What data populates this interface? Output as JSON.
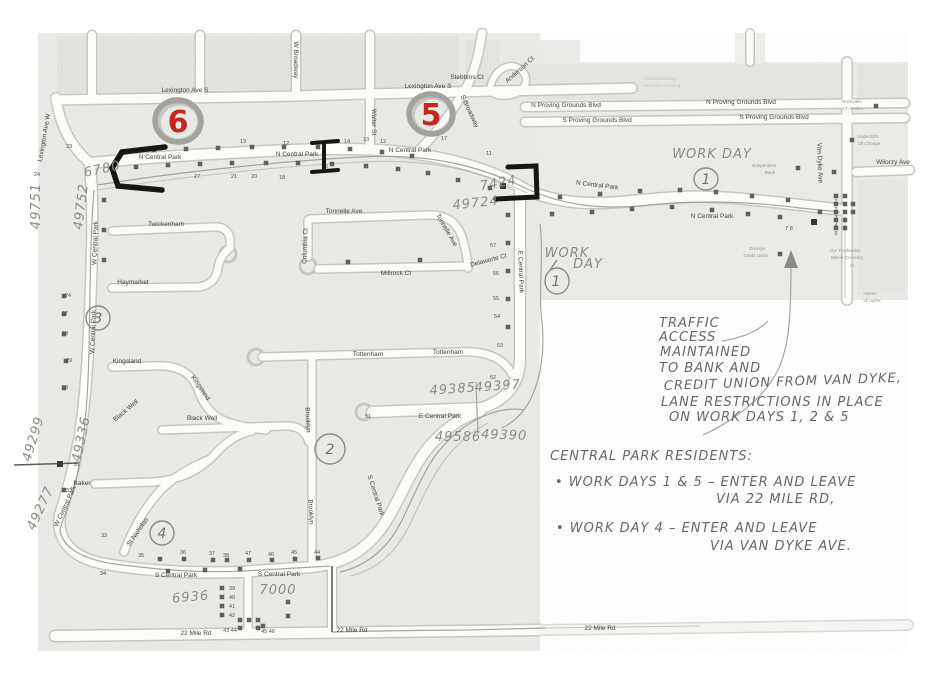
{
  "map": {
    "street_labels": [
      {
        "t": "Lexington Ave S",
        "x": 185,
        "y": 92
      },
      {
        "t": "Lexington Ave S",
        "x": 428,
        "y": 88
      },
      {
        "t": "Lexington Ave W",
        "x": 46,
        "y": 138,
        "r": -80,
        "s": 5.5
      },
      {
        "t": "W Broadway",
        "x": 294,
        "y": 60,
        "r": 90,
        "s": 5.5
      },
      {
        "t": "Walter St",
        "x": 372,
        "y": 122,
        "r": 90,
        "s": 5.5
      },
      {
        "t": "S Broadway",
        "x": 468,
        "y": 112,
        "r": 65,
        "s": 5.5
      },
      {
        "t": "Stebbins Ct",
        "x": 467,
        "y": 79,
        "s": 5.5
      },
      {
        "t": "Anderson Ct",
        "x": 521,
        "y": 71,
        "r": -42,
        "s": 5
      },
      {
        "t": "N Central Park",
        "x": 160,
        "y": 159
      },
      {
        "t": "N Central Park",
        "x": 297,
        "y": 156
      },
      {
        "t": "N Central Park",
        "x": 410,
        "y": 152
      },
      {
        "t": "N Central Park",
        "x": 597,
        "y": 187,
        "r": 7,
        "s": 6
      },
      {
        "t": "N Central Park",
        "x": 712,
        "y": 218
      },
      {
        "t": "W Central Park",
        "x": 97,
        "y": 243,
        "r": -88,
        "s": 5.5
      },
      {
        "t": "W Central Park",
        "x": 95,
        "y": 332,
        "r": -88,
        "s": 5.5
      },
      {
        "t": "W Central Park",
        "x": 67,
        "y": 507,
        "r": -65,
        "s": 5.5
      },
      {
        "t": "E Central Park",
        "x": 519,
        "y": 272,
        "r": 88,
        "s": 5.5
      },
      {
        "t": "E Central Park",
        "x": 440,
        "y": 418,
        "s": 6
      },
      {
        "t": "S Central Park",
        "x": 176,
        "y": 577,
        "s": 6
      },
      {
        "t": "S Central Park",
        "x": 279,
        "y": 576,
        "s": 6
      },
      {
        "t": "S Central Park",
        "x": 374,
        "y": 496,
        "r": 72,
        "s": 5.5
      },
      {
        "t": "22 Mile Rd",
        "x": 196,
        "y": 635
      },
      {
        "t": "22 Mile Rd",
        "x": 352,
        "y": 632
      },
      {
        "t": "22 Mile Rd",
        "x": 600,
        "y": 630,
        "s": 7
      },
      {
        "t": "N Proving Grounds Blvd",
        "x": 566,
        "y": 107,
        "s": 6
      },
      {
        "t": "N Proving Grounds Blvd",
        "x": 741,
        "y": 104,
        "s": 6
      },
      {
        "t": "S Proving Grounds Blvd",
        "x": 597,
        "y": 122,
        "s": 6
      },
      {
        "t": "S Proving Grounds Blvd",
        "x": 774,
        "y": 119,
        "s": 6
      },
      {
        "t": "Van Dyke Ave",
        "x": 818,
        "y": 163,
        "r": 88,
        "s": 6
      },
      {
        "t": "Wilorzy Ave",
        "x": 893,
        "y": 164,
        "s": 6
      },
      {
        "t": "Twickenham",
        "x": 166,
        "y": 226,
        "s": 5.5
      },
      {
        "t": "Tonnelle Ave",
        "x": 344,
        "y": 213,
        "s": 5.5
      },
      {
        "t": "Tonnelle Ave",
        "x": 445,
        "y": 231,
        "r": 60,
        "s": 5.5
      },
      {
        "t": "Millrock Ct",
        "x": 396,
        "y": 275,
        "s": 5.5
      },
      {
        "t": "Delaworte Ct",
        "x": 489,
        "y": 262,
        "r": -15,
        "s": 5
      },
      {
        "t": "Columbia Ct",
        "x": 307,
        "y": 246,
        "r": -88,
        "s": 5
      },
      {
        "t": "Haymarket",
        "x": 133,
        "y": 284,
        "s": 5.5
      },
      {
        "t": "Kingsland",
        "x": 127,
        "y": 363,
        "s": 5.5
      },
      {
        "t": "Kingsland",
        "x": 199,
        "y": 389,
        "r": 55,
        "s": 5.5
      },
      {
        "t": "Tottenham",
        "x": 368,
        "y": 356,
        "s": 5.5
      },
      {
        "t": "Tottenham",
        "x": 448,
        "y": 354,
        "s": 5.5
      },
      {
        "t": "Black Well",
        "x": 202,
        "y": 420,
        "s": 5.5
      },
      {
        "t": "Black Well",
        "x": 127,
        "y": 412,
        "r": -40,
        "s": 5
      },
      {
        "t": "Baker",
        "x": 82,
        "y": 485,
        "s": 5.5
      },
      {
        "t": "Brooklyn",
        "x": 306,
        "y": 420,
        "r": 88,
        "s": 5.5
      },
      {
        "t": "Brooklyn",
        "x": 309,
        "y": 512,
        "r": 88,
        "s": 5.5
      },
      {
        "t": "St Nicholas",
        "x": 139,
        "y": 533,
        "r": -55,
        "s": 5.5
      }
    ],
    "lot_numbers": [
      {
        "t": "23",
        "x": 69,
        "y": 148
      },
      {
        "t": "24",
        "x": 37,
        "y": 176
      },
      {
        "t": "27",
        "x": 197,
        "y": 178
      },
      {
        "t": "21",
        "x": 234,
        "y": 178
      },
      {
        "t": "20",
        "x": 254,
        "y": 178
      },
      {
        "t": "18",
        "x": 282,
        "y": 179
      },
      {
        "t": "13",
        "x": 243,
        "y": 143
      },
      {
        "t": "12",
        "x": 286,
        "y": 145
      },
      {
        "t": "14",
        "x": 347,
        "y": 143
      },
      {
        "t": "13",
        "x": 366,
        "y": 141
      },
      {
        "t": "12",
        "x": 383,
        "y": 143
      },
      {
        "t": "15",
        "x": 325,
        "y": 168
      },
      {
        "t": "17",
        "x": 444,
        "y": 140
      },
      {
        "t": "11",
        "x": 489,
        "y": 155
      },
      {
        "t": "24",
        "x": 68,
        "y": 297
      },
      {
        "t": "27",
        "x": 65,
        "y": 315
      },
      {
        "t": "28",
        "x": 65,
        "y": 335
      },
      {
        "t": "29",
        "x": 69,
        "y": 362
      },
      {
        "t": "30",
        "x": 65,
        "y": 389
      },
      {
        "t": "31",
        "x": 77,
        "y": 466
      },
      {
        "t": "32",
        "x": 69,
        "y": 492
      },
      {
        "t": "33",
        "x": 104,
        "y": 537
      },
      {
        "t": "34",
        "x": 103,
        "y": 575
      },
      {
        "t": "57",
        "x": 493,
        "y": 247
      },
      {
        "t": "56",
        "x": 496,
        "y": 275
      },
      {
        "t": "55",
        "x": 496,
        "y": 300
      },
      {
        "t": "54",
        "x": 497,
        "y": 318
      },
      {
        "t": "53",
        "x": 500,
        "y": 347
      },
      {
        "t": "52",
        "x": 493,
        "y": 379
      },
      {
        "t": "51",
        "x": 368,
        "y": 418
      },
      {
        "t": "35",
        "x": 141,
        "y": 557
      },
      {
        "t": "36",
        "x": 183,
        "y": 554
      },
      {
        "t": "37",
        "x": 212,
        "y": 555
      },
      {
        "t": "38",
        "x": 226,
        "y": 557
      },
      {
        "t": "47",
        "x": 248,
        "y": 555
      },
      {
        "t": "46",
        "x": 271,
        "y": 556
      },
      {
        "t": "45",
        "x": 294,
        "y": 554
      },
      {
        "t": "44",
        "x": 317,
        "y": 554
      },
      {
        "t": "39",
        "x": 232,
        "y": 590
      },
      {
        "t": "40",
        "x": 232,
        "y": 599
      },
      {
        "t": "41",
        "x": 232,
        "y": 608
      },
      {
        "t": "42",
        "x": 232,
        "y": 617
      },
      {
        "t": "43 44",
        "x": 230,
        "y": 632
      },
      {
        "t": "45 46",
        "x": 268,
        "y": 633
      },
      {
        "t": "1",
        "x": 836,
        "y": 203
      },
      {
        "t": "2",
        "x": 836,
        "y": 211
      },
      {
        "t": "3",
        "x": 836,
        "y": 219
      },
      {
        "t": "4",
        "x": 836,
        "y": 227
      },
      {
        "t": "5",
        "x": 836,
        "y": 235
      },
      {
        "t": "7 8",
        "x": 789,
        "y": 230
      }
    ],
    "poi_labels": [
      {
        "t": "Packard Proving",
        "x": 660,
        "y": 80,
        "s": 5,
        "c": "fade"
      },
      {
        "t": "Grounds Crossing",
        "x": 662,
        "y": 87,
        "s": 5,
        "c": "fade"
      },
      {
        "t": "Rockvalle",
        "x": 852,
        "y": 103
      },
      {
        "t": "Ch Prahm",
        "x": 853,
        "y": 110
      },
      {
        "t": "Uncle Ed's",
        "x": 868,
        "y": 138
      },
      {
        "t": "Oil Change",
        "x": 869,
        "y": 145
      },
      {
        "t": "Independent",
        "x": 764,
        "y": 167
      },
      {
        "t": "Bank",
        "x": 770,
        "y": 174
      },
      {
        "t": "Genisys",
        "x": 757,
        "y": 250
      },
      {
        "t": "Credit Union",
        "x": 756,
        "y": 257
      },
      {
        "t": "Our Fredericka",
        "x": 845,
        "y": 252
      },
      {
        "t": "Manor Crossing",
        "x": 847,
        "y": 259
      },
      {
        "t": "11",
        "x": 852,
        "y": 267
      },
      {
        "t": "Haven",
        "x": 870,
        "y": 295
      },
      {
        "t": "of Lights",
        "x": 872,
        "y": 302
      }
    ]
  },
  "annotations": {
    "zone_numbers_red": [
      "6",
      "5"
    ],
    "zone_numbers_pencil": [
      "3",
      "2",
      "4"
    ],
    "work_day_circle_number": "1",
    "addresses": [
      {
        "t": "6780",
        "x": 103,
        "y": 173,
        "r": -12,
        "s": 15
      },
      {
        "t": "49751",
        "x": 40,
        "y": 206,
        "r": -90,
        "s": 11
      },
      {
        "t": "49752",
        "x": 85,
        "y": 207,
        "r": -83,
        "s": 11
      },
      {
        "t": "7424",
        "x": 499,
        "y": 187,
        "r": -10,
        "s": 14
      },
      {
        "t": "49724",
        "x": 476,
        "y": 207,
        "r": -6,
        "s": 13
      },
      {
        "t": "49385",
        "x": 453,
        "y": 393,
        "r": -4,
        "s": 13
      },
      {
        "t": "49397",
        "x": 498,
        "y": 390,
        "r": -4,
        "s": 13
      },
      {
        "t": "49586",
        "x": 458,
        "y": 441,
        "s": 13
      },
      {
        "t": "49390",
        "x": 504,
        "y": 439,
        "r": 2,
        "s": 13
      },
      {
        "t": "49299",
        "x": 37,
        "y": 440,
        "r": -73,
        "s": 11
      },
      {
        "t": "49336",
        "x": 85,
        "y": 440,
        "r": -78,
        "s": 11
      },
      {
        "t": "49277",
        "x": 44,
        "y": 510,
        "r": -65,
        "s": 11
      },
      {
        "t": "6936",
        "x": 191,
        "y": 601,
        "r": -5,
        "s": 14
      },
      {
        "t": "7000",
        "x": 278,
        "y": 594,
        "s": 14
      }
    ],
    "work_day_labels": [
      {
        "t": "WORK DAY",
        "x": 712,
        "y": 158,
        "s": 11,
        "ls": 4
      },
      {
        "t": "WORK",
        "x": 567,
        "y": 257,
        "s": 9,
        "ls": 2
      },
      {
        "t": "DAY",
        "x": 588,
        "y": 268,
        "s": 9,
        "ls": 2
      }
    ],
    "traffic_note": [
      {
        "t": "TRAFFIC",
        "x": 659,
        "y": 327,
        "s": 10,
        "ls": 1.5
      },
      {
        "t": "ACCESS",
        "x": 659,
        "y": 341,
        "s": 10,
        "ls": 1.5
      },
      {
        "t": "MAINTAINED",
        "x": 660,
        "y": 356,
        "s": 10,
        "ls": 1.5
      },
      {
        "t": "TO BANK AND",
        "x": 659,
        "y": 372,
        "s": 10.5,
        "ls": 1.5
      },
      {
        "t": "CREDIT UNION FROM VAN DYKE,",
        "x": 664,
        "y": 390,
        "s": 11,
        "ls": 1.5,
        "r": -2
      },
      {
        "t": "LANE RESTRICTIONS IN PLACE",
        "x": 661,
        "y": 406,
        "s": 11,
        "ls": 1.5
      },
      {
        "t": "ON WORK DAYS 1, 2 & 5",
        "x": 669,
        "y": 421,
        "s": 11.5,
        "ls": 1.5
      }
    ],
    "residents_note": [
      {
        "t": "CENTRAL PARK RESIDENTS:",
        "x": 550,
        "y": 460,
        "s": 11,
        "ls": 1.5
      },
      {
        "t": "• WORK DAYS 1 & 5  –  ENTER AND LEAVE",
        "x": 555,
        "y": 486,
        "s": 11,
        "ls": 1.2
      },
      {
        "t": "VIA 22 MILE RD,",
        "x": 716,
        "y": 503,
        "s": 11,
        "ls": 1.5
      },
      {
        "t": "• WORK DAY 4     –  ENTER AND LEAVE",
        "x": 556,
        "y": 532,
        "s": 11,
        "ls": 1.2
      },
      {
        "t": "VIA VAN DYKE AVE.",
        "x": 710,
        "y": 550,
        "s": 11,
        "ls": 1.5
      }
    ]
  },
  "colors": {
    "red_marker": "#c4271e",
    "pencil": "#8b8b86",
    "ink": "#686763",
    "paper": "#eaeae7"
  }
}
